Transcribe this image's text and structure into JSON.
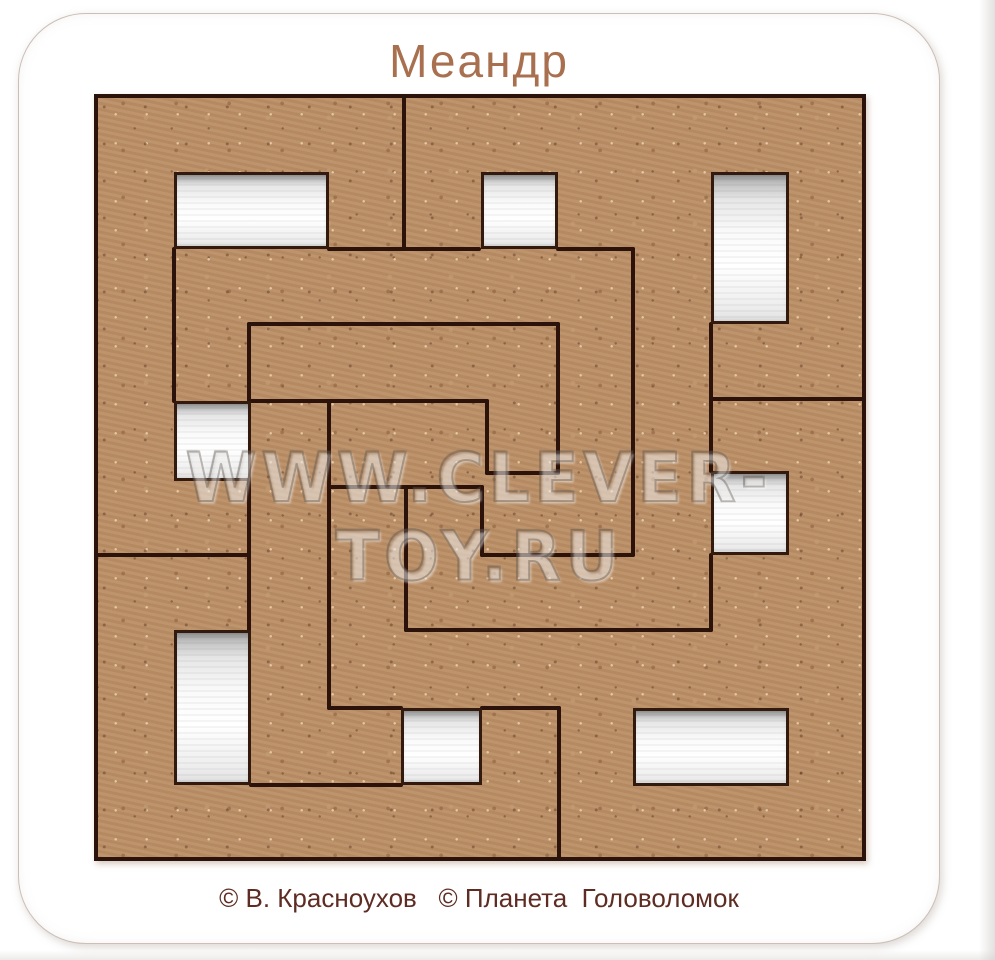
{
  "photo": {
    "width": 995,
    "height": 960
  },
  "board": {
    "title": "Меандр",
    "watermark": "WWW.CLEVER-TOY.RU",
    "credits": "© В. Красноухов   © Планета  Головоломок"
  },
  "colors": {
    "mdf": "#b98e66",
    "cut": "#2b120a",
    "tray_white": "#f7f7f7",
    "title": "#a97050",
    "credits": "#5e2c22",
    "watermark": "#6f675f",
    "board_bg": "#ffffff",
    "board_edge": "#cbbfb7"
  },
  "puzzle": {
    "left": 75,
    "top": 80,
    "width": 772,
    "height": 767,
    "grid_cell": 77,
    "holes": [
      {
        "name": "tray-hole-top-left",
        "x": 80,
        "y": 78,
        "w": 155,
        "h": 77
      },
      {
        "name": "tray-hole-top-middle",
        "x": 387,
        "y": 78,
        "w": 77,
        "h": 77
      },
      {
        "name": "tray-hole-top-right",
        "x": 617,
        "y": 78,
        "w": 78,
        "h": 152
      },
      {
        "name": "tray-hole-left-upper",
        "x": 80,
        "y": 307,
        "w": 77,
        "h": 80
      },
      {
        "name": "tray-hole-left-lower",
        "x": 80,
        "y": 536,
        "w": 77,
        "h": 155
      },
      {
        "name": "tray-hole-bottom-middle",
        "x": 307,
        "y": 614,
        "w": 81,
        "h": 77
      },
      {
        "name": "tray-hole-right-middle",
        "x": 617,
        "y": 377,
        "w": 78,
        "h": 84
      },
      {
        "name": "tray-hole-bottom-right",
        "x": 539,
        "y": 614,
        "w": 156,
        "h": 78
      }
    ],
    "cuts": [
      {
        "x": 308,
        "y": 0,
        "w": 4,
        "h": 157
      },
      {
        "x": 233,
        "y": 153,
        "w": 154,
        "h": 4
      },
      {
        "x": 462,
        "y": 153,
        "w": 79,
        "h": 4
      },
      {
        "x": 537,
        "y": 153,
        "w": 4,
        "h": 310
      },
      {
        "x": 386,
        "y": 459,
        "w": 155,
        "h": 4
      },
      {
        "x": 386,
        "y": 391,
        "w": 4,
        "h": 72
      },
      {
        "x": 233,
        "y": 391,
        "w": 157,
        "h": 4
      },
      {
        "x": 310,
        "y": 391,
        "w": 4,
        "h": 147
      },
      {
        "x": 310,
        "y": 534,
        "w": 309,
        "h": 4
      },
      {
        "x": 615,
        "y": 459,
        "w": 4,
        "h": 79
      },
      {
        "x": 391,
        "y": 305,
        "w": 4,
        "h": 76
      },
      {
        "x": 391,
        "y": 377,
        "w": 75,
        "h": 4
      },
      {
        "x": 462,
        "y": 228,
        "w": 4,
        "h": 153
      },
      {
        "x": 153,
        "y": 228,
        "w": 313,
        "h": 4
      },
      {
        "x": 153,
        "y": 228,
        "w": 4,
        "h": 81
      },
      {
        "x": 153,
        "y": 385,
        "w": 4,
        "h": 153
      },
      {
        "x": 0,
        "y": 459,
        "w": 157,
        "h": 4
      },
      {
        "x": 155,
        "y": 305,
        "w": 240,
        "h": 4
      },
      {
        "x": 233,
        "y": 305,
        "w": 4,
        "h": 311
      },
      {
        "x": 233,
        "y": 612,
        "w": 76,
        "h": 4
      },
      {
        "x": 155,
        "y": 689,
        "w": 154,
        "h": 4
      },
      {
        "x": 386,
        "y": 612,
        "w": 81,
        "h": 4
      },
      {
        "x": 463,
        "y": 612,
        "w": 4,
        "h": 155
      },
      {
        "x": 615,
        "y": 228,
        "w": 4,
        "h": 151
      },
      {
        "x": 615,
        "y": 303,
        "w": 157,
        "h": 4
      },
      {
        "x": 78,
        "y": 153,
        "w": 4,
        "h": 156
      }
    ]
  }
}
